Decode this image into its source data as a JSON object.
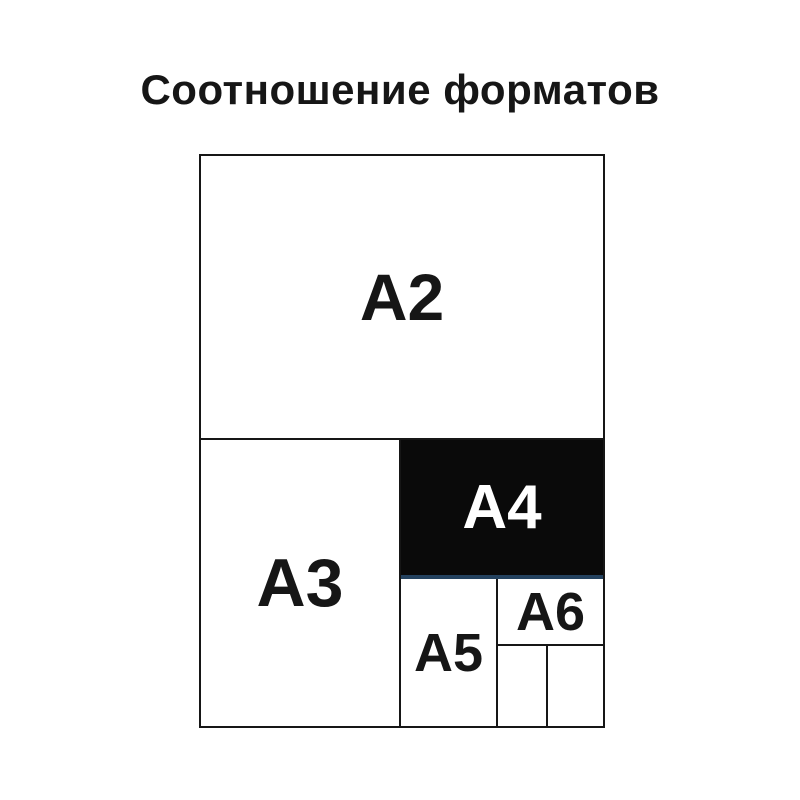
{
  "title": "Соотношение форматов",
  "diagram": {
    "description": "nested-paper-format-size-comparison",
    "formats": {
      "a2": {
        "label": "A2"
      },
      "a3": {
        "label": "A3"
      },
      "a4": {
        "label": "A4"
      },
      "a5": {
        "label": "A5"
      },
      "a6": {
        "label": "A6"
      }
    },
    "unlabeled_cells": 2,
    "colors": {
      "background": "#ffffff",
      "line": "#161616",
      "text": "#161616",
      "a4_fill": "#0a0a0a",
      "a4_text": "#ffffff",
      "a4_underline": "#24425f"
    }
  }
}
